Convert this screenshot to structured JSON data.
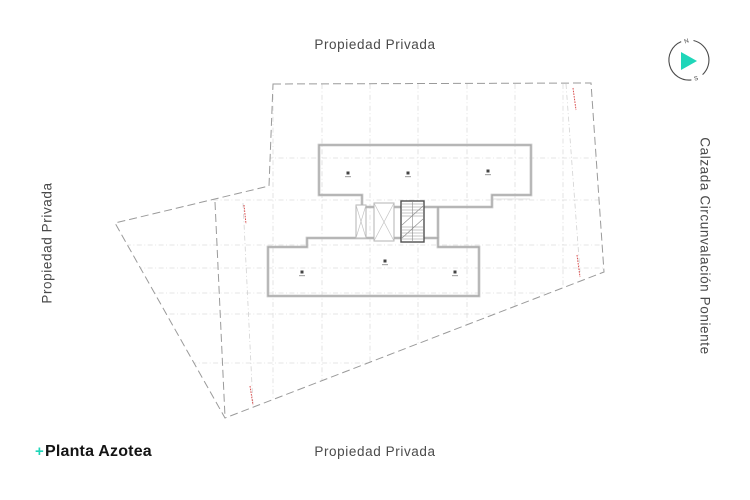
{
  "title": {
    "icon": "+",
    "text": "Planta Azotea"
  },
  "boundary_labels": {
    "top": "Propiedad Privada",
    "bottom": "Propiedad Privada",
    "left": "Propiedad Privada",
    "right": "Calzada Circunvalación Poniente"
  },
  "compass": {
    "north_label": "N",
    "south_label": "S"
  },
  "icons": {
    "title_plus": "plus-icon",
    "compass": "north-arrow-icon",
    "roof_drain": "roof-drain-icon",
    "stair": "stair-core-icon",
    "elevator": "elevator-shaft-icon"
  },
  "colors": {
    "accent_teal": "#1fd6b9",
    "boundary_gray": "#9a9a9a",
    "wall_light": "#cdcdcd",
    "wall_core": "#9e9e9e",
    "grid_gray": "#dcdcdc",
    "marker_red": "#d94f4f",
    "label_text": "#4a4a4a",
    "title_text": "#141414"
  }
}
